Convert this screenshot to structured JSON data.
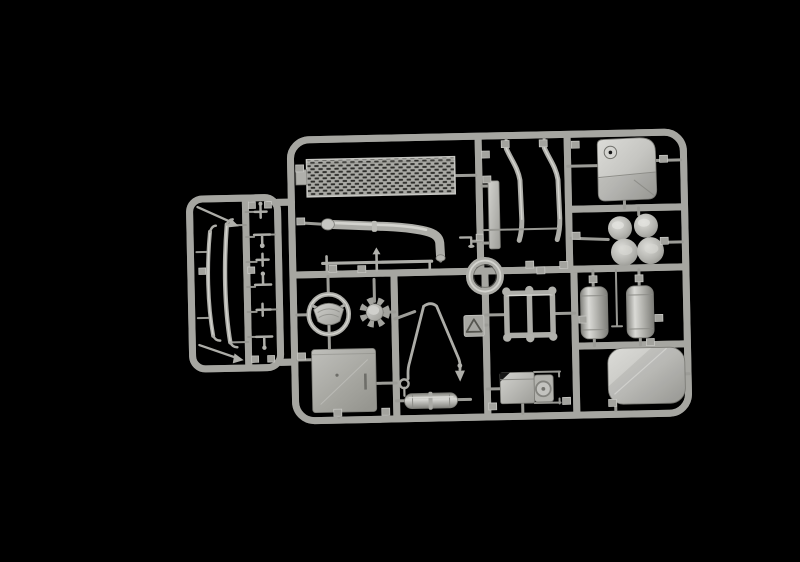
{
  "meta": {
    "description": "Product photograph of an injection-moulded model kit sprue: light grey plastic parts tree for a truck model, shown on a pure black background. A large rectangular main sprue with rounded corners holds a perforated grille panel, a curved exhaust pipe, bent bracket strips, a fuel tank, two contoured seat cushions, a mounting ring, a steering wheel, a toothed hub, an A-shaped tow drawbar, a warning-triangle plate, a rack frame, two cylindrical air tanks, a rounded roof panel, a large flat floor panel, a small muffler and a battery box. A smaller side sprue on the left holds leaf springs, thin rods and small fittings."
  },
  "colors": {
    "background": "#000000",
    "plastic_base": "#a6a6a1",
    "plastic_highlight": "#d9d9d5",
    "plastic_shadow": "#73736e",
    "grille_holes": "#2e2e2b"
  },
  "sprue": {
    "main_label": "Main sprue frame",
    "side_label": "Side sprue frame",
    "parts": [
      {
        "id": "walkway-grille",
        "label": "Perforated grille / walkway panel"
      },
      {
        "id": "exhaust-pipe",
        "label": "Curved exhaust pipe with flared tip"
      },
      {
        "id": "radiator-side-panel",
        "label": "Narrow flat side panel"
      },
      {
        "id": "fender-brackets",
        "label": "Pair of bent bracket strips"
      },
      {
        "id": "fuel-tank",
        "label": "Fuel tank with filler cap"
      },
      {
        "id": "seat-cushions",
        "label": "Two contoured seat cushions"
      },
      {
        "id": "mounting-ring",
        "label": "Circular mounting ring"
      },
      {
        "id": "steering-wheel",
        "label": "Steering wheel with horn pad"
      },
      {
        "id": "gear-hub",
        "label": "Toothed hub / gear wheel"
      },
      {
        "id": "tow-frame",
        "label": "A-shaped tow drawbar"
      },
      {
        "id": "warning-triangle",
        "label": "Warning triangle plate"
      },
      {
        "id": "roof-rack-frame",
        "label": "Rectangular rack frame with round feet"
      },
      {
        "id": "air-tanks",
        "label": "Two cylindrical air tanks"
      },
      {
        "id": "roof-panel",
        "label": "Rounded roof panel"
      },
      {
        "id": "floor-panel",
        "label": "Large flat floor panel"
      },
      {
        "id": "muffler",
        "label": "Small muffler cylinder"
      },
      {
        "id": "battery-box",
        "label": "Battery box with round cap and rods"
      },
      {
        "id": "tie-bar",
        "label": "Thin tie bar with stubs"
      },
      {
        "id": "pipe-bracket",
        "label": "Small L-bracket"
      },
      {
        "id": "antenna-rod-top",
        "label": "Thin diagonal rod (top)"
      },
      {
        "id": "leaf-springs",
        "label": "Two leaf springs"
      },
      {
        "id": "small-fittings",
        "label": "Column of small fittings"
      },
      {
        "id": "antenna-rod-bottom",
        "label": "Thin diagonal rod (bottom)"
      }
    ]
  }
}
